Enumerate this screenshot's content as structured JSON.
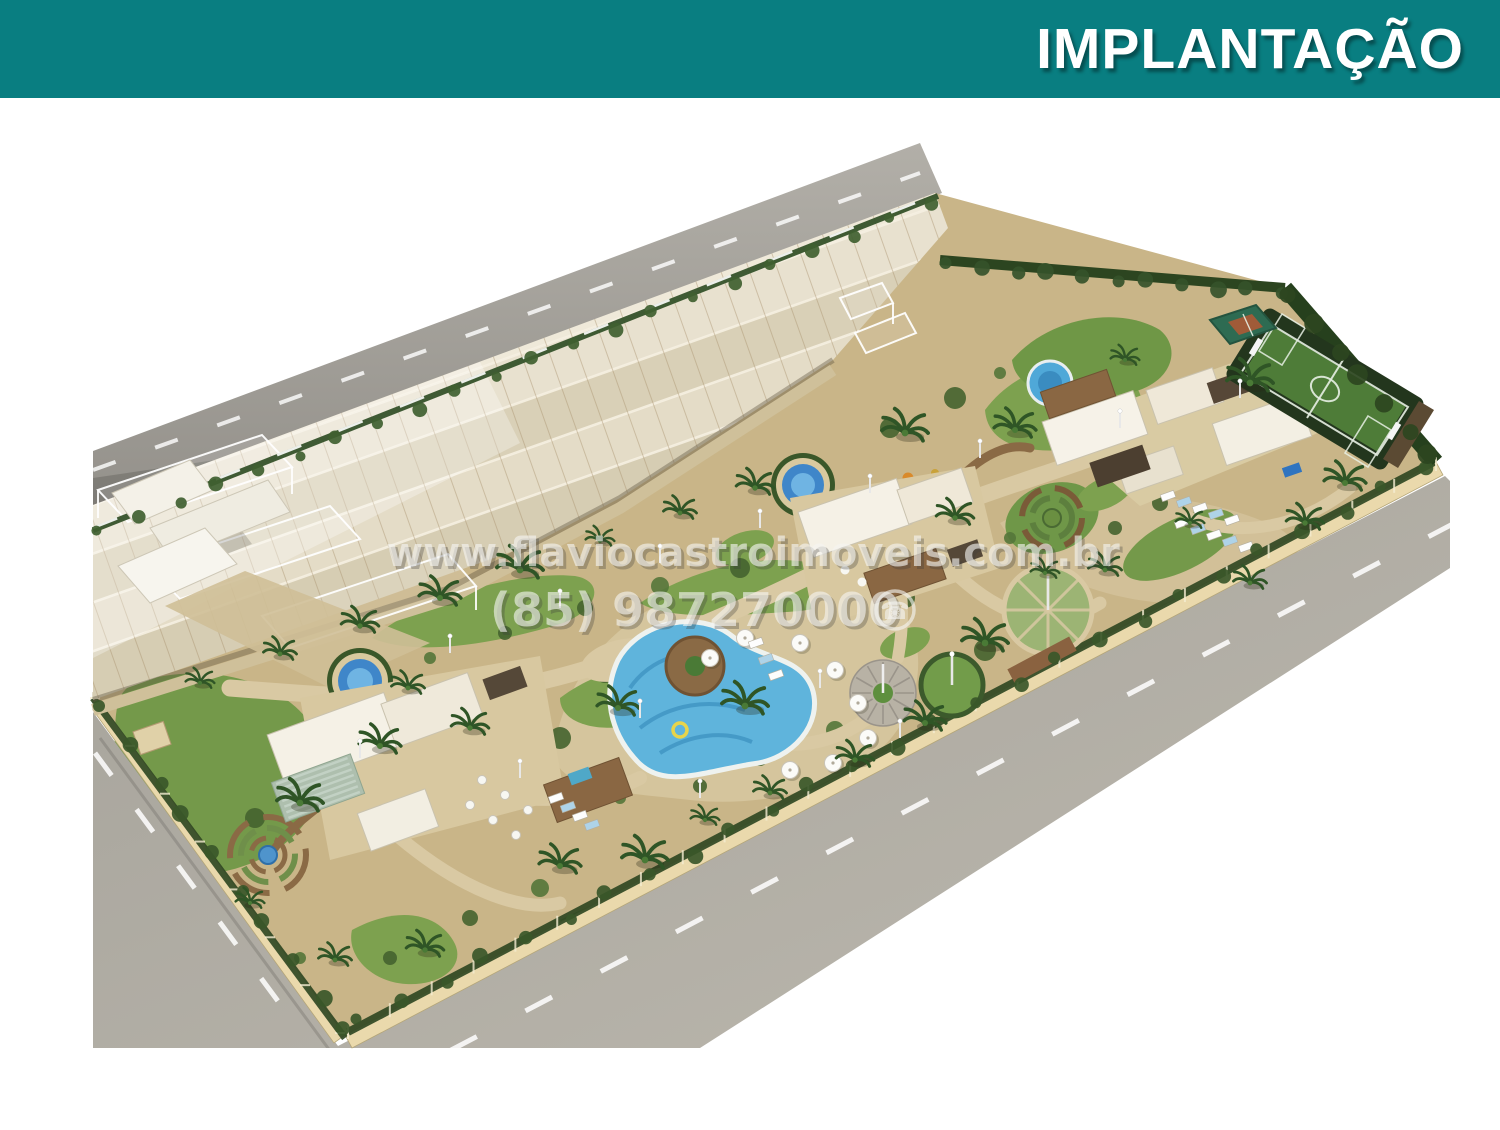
{
  "slide": {
    "title": "IMPLANTAÇÃO",
    "header_bg_color": "#097e81",
    "title_color": "#ffffff"
  },
  "watermark": {
    "line1": "www.flaviocastroimoveis.com.br",
    "line2": "(85) 987270000",
    "phone_glyph": "☎",
    "color": "#f5f5f2"
  },
  "scene": {
    "kind": "aerial-3d-site-plan-render",
    "features": [
      "boundary-road-north",
      "boundary-road-southwest",
      "boundary-road-southeast",
      "lane-markings",
      "townhouse-rows",
      "ghost-unit-wireframes",
      "perimeter-wall",
      "perimeter-hedge",
      "entrance-gatehouse",
      "event-lawn",
      "round-fountain-west",
      "round-fountain-center",
      "spiral-garden-west",
      "spiral-garden-east",
      "clubhouse-west",
      "green-glass-pergola",
      "clubhouse-center",
      "clubhouse-east",
      "sun-loungers",
      "main-pool",
      "pool-deck-island",
      "pool-umbrellas",
      "kids-splash-pool",
      "water-slide",
      "playground",
      "gazebo-plaza",
      "garden-circle",
      "lawn-circle",
      "soccer-field",
      "multisport-court",
      "palm-trees"
    ]
  }
}
